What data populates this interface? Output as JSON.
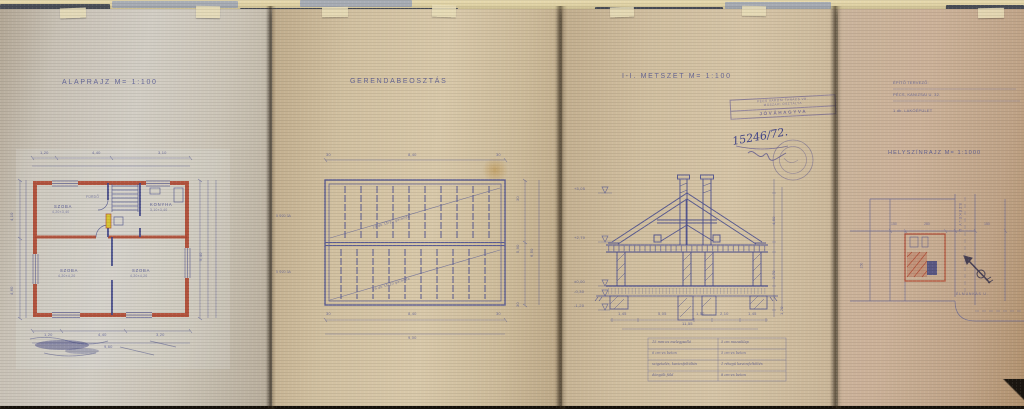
{
  "colors": {
    "paper": "#d0c2a5",
    "ink": "#4d5190",
    "wall_red": "#b04a33",
    "marker_yellow": "#d6c433",
    "rail_dark": "#4c505a",
    "rail_light": "#a9aeb6"
  },
  "sheets": {
    "alaprajz": {
      "title": "ALAPRAJZ  M= 1:100",
      "rooms": {
        "szoba_nagy": "SZOBA",
        "szoba_nagy_meret": "4,20×3,40",
        "furdo": "FÜRDŐ",
        "konyha": "KONYHA",
        "konyha_meret": "3,10×3,40",
        "szoba_dny": "SZOBA",
        "szoba_dny_meret": "4,20×4,20",
        "szoba_dk": "SZOBA",
        "szoba_dk_meret": "4,20×4,20"
      },
      "dims": {
        "top": [
          "1,20",
          "4,40",
          "3,10"
        ],
        "left": [
          "4,10",
          "4,60"
        ],
        "right": [
          "9,40"
        ],
        "bottom": [
          "1,20",
          "4,40",
          "3,20"
        ],
        "bottom_total": "9,60"
      }
    },
    "gerendabeosztas": {
      "title": "GERENDABEOSZTÁS",
      "beam_notes": [
        "19 db 15/20 gerenda",
        "19 db 15/20 gerenda"
      ],
      "vasalas": [
        "5 Φ20 3A",
        "5 Φ20 3A"
      ],
      "dims": {
        "top": [
          "30",
          "8,40",
          "30"
        ],
        "bottom": [
          "30",
          "8,40",
          "30"
        ],
        "bottom_total": "9,00",
        "right": [
          "30",
          "5,90",
          "30"
        ],
        "right_total": "6,50"
      }
    },
    "metszet": {
      "title": "I-I. METSZET  M= 1:100",
      "stamp": {
        "line1": "PÉCS VÁROSI TANÁCS VB.",
        "line2": "MŰSZAKI OSZTÁLYA",
        "approved": "JÓVÁHAGYVA",
        "ugyiratszam": "15246/72."
      },
      "levels": [
        "+5,05",
        "+2,70",
        "±0,00",
        "-0,30",
        "-1,20"
      ],
      "dims": {
        "right": [
          "4,50",
          "2,70",
          "1,20"
        ],
        "bottom": [
          "1,45",
          "5,05",
          "1,50",
          "2,10",
          "1,45"
        ],
        "bottom_total": "11,55"
      },
      "retegrend": {
        "left": [
          "15 mm-es melegpadló",
          "6 cm-es beton",
          "szigetelés, kavicsfeltöltés",
          "döngölt föld"
        ],
        "right": [
          "5 cm mozaiklap",
          "5 cm-es beton",
          "1 rétegű kavicsfeltöltés",
          "8 cm-es beton"
        ]
      }
    },
    "helyszinrajz": {
      "header": [
        "ÉPÍTŐ TERVEZŐ:",
        "PÉCS, KANIZSAI U. 32.",
        "1 db. LAKÓÉPÜLET"
      ],
      "title": "HELYSZÍNRAJZ  M= 1:1000",
      "streets": {
        "fuggoleges": "SZÉKELY U.",
        "vizszintes": "ÉLMUNKÁS U."
      },
      "dims": [
        "150",
        "280",
        "150"
      ],
      "dims_left": "150"
    }
  }
}
